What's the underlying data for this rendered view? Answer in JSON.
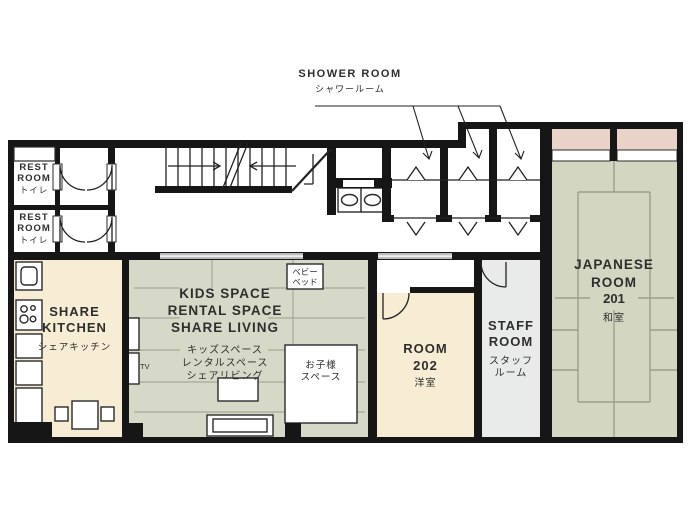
{
  "plan_type": "floor-plan",
  "colors": {
    "wall": "#161616",
    "kitchen_beige": "#f7ecd4",
    "living_green": "#d6d9c7",
    "tatami_green": "#d3d7c2",
    "closet_pink": "#e9d2c8",
    "staff_gray": "#e9ebea",
    "floor_line": "#a6a998",
    "tatami_line": "#99a089",
    "window_gray": "#bcbcbc"
  },
  "rooms": {
    "shower_room": {
      "en": "SHOWER ROOM",
      "ja": "シャワールーム"
    },
    "rest_room_1": {
      "en": "REST ROOM",
      "ja": "トイレ"
    },
    "rest_room_2": {
      "en": "REST ROOM",
      "ja": "トイレ"
    },
    "share_kitchen": {
      "en": "SHARE KITCHEN",
      "ja": "シェアキッチン"
    },
    "kids_space": {
      "en1": "KIDS SPACE",
      "en2": "RENTAL SPACE",
      "en3": "SHARE LIVING",
      "ja1": "キッズスペース",
      "ja2": "レンタルスペース",
      "ja3": "シェアリビング"
    },
    "room_202": {
      "en": "ROOM",
      "number": "202",
      "ja": "洋室"
    },
    "staff_room": {
      "en": "STAFF ROOM",
      "ja": "スタッフルーム"
    },
    "japanese_room": {
      "en": "JAPANESE ROOM",
      "number": "201",
      "ja": "和室"
    },
    "baby_bed": {
      "ja1": "ベビー",
      "ja2": "ベッド"
    },
    "kids_corner": {
      "ja1": "お子様",
      "ja2": "スペース"
    },
    "tv": {
      "label": "TV"
    }
  }
}
